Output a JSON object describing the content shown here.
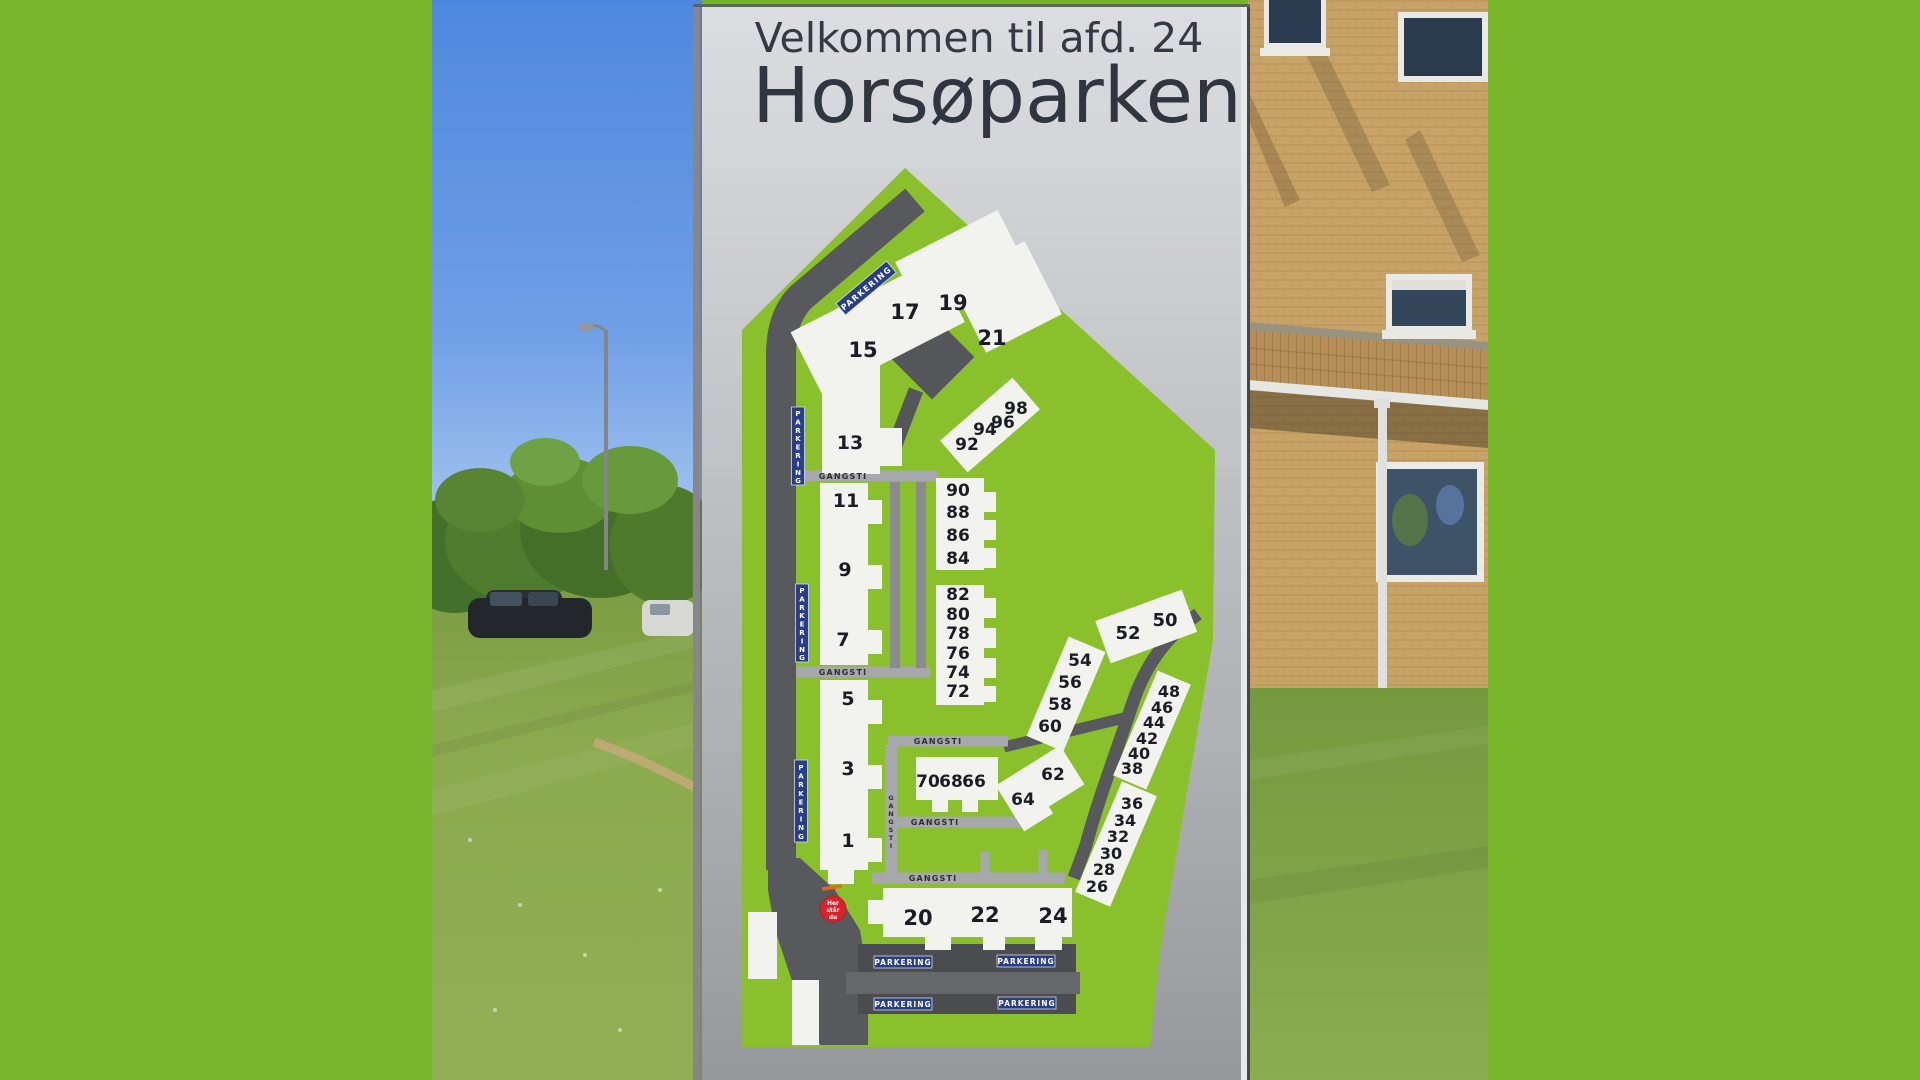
{
  "sign": {
    "title_line1": "Velkommen til afd. 24",
    "title_line2": "Horsøparken"
  },
  "map": {
    "legend": {
      "parkering": "PARKERING",
      "gangsti": "GANGSTI",
      "marker_line1": "Her",
      "marker_line2": "står",
      "marker_line3": "du"
    },
    "numbers": {
      "1": "1",
      "3": "3",
      "5": "5",
      "7": "7",
      "9": "9",
      "11": "11",
      "13": "13",
      "15": "15",
      "17": "17",
      "19": "19",
      "21": "21",
      "20": "20",
      "22": "22",
      "24": "24",
      "26": "26",
      "28": "28",
      "30": "30",
      "32": "32",
      "34": "34",
      "36": "36",
      "38": "38",
      "40": "40",
      "42": "42",
      "44": "44",
      "46": "46",
      "48": "48",
      "50": "50",
      "52": "52",
      "54": "54",
      "56": "56",
      "58": "58",
      "60": "60",
      "62": "62",
      "64": "64",
      "66": "66",
      "68": "68",
      "70": "70",
      "72": "72",
      "74": "74",
      "76": "76",
      "78": "78",
      "80": "80",
      "82": "82",
      "84": "84",
      "86": "86",
      "88": "88",
      "90": "90",
      "92": "92",
      "94": "94",
      "96": "96",
      "98": "98"
    }
  },
  "colors": {
    "border_green": "#76b628",
    "map_green": "#8ac02b",
    "road_gray": "#58595d",
    "path_gray": "#a7a8ac",
    "badge_blue": "#2a3e85",
    "marker_red": "#d7232b",
    "building_white": "#f2f3ef"
  }
}
